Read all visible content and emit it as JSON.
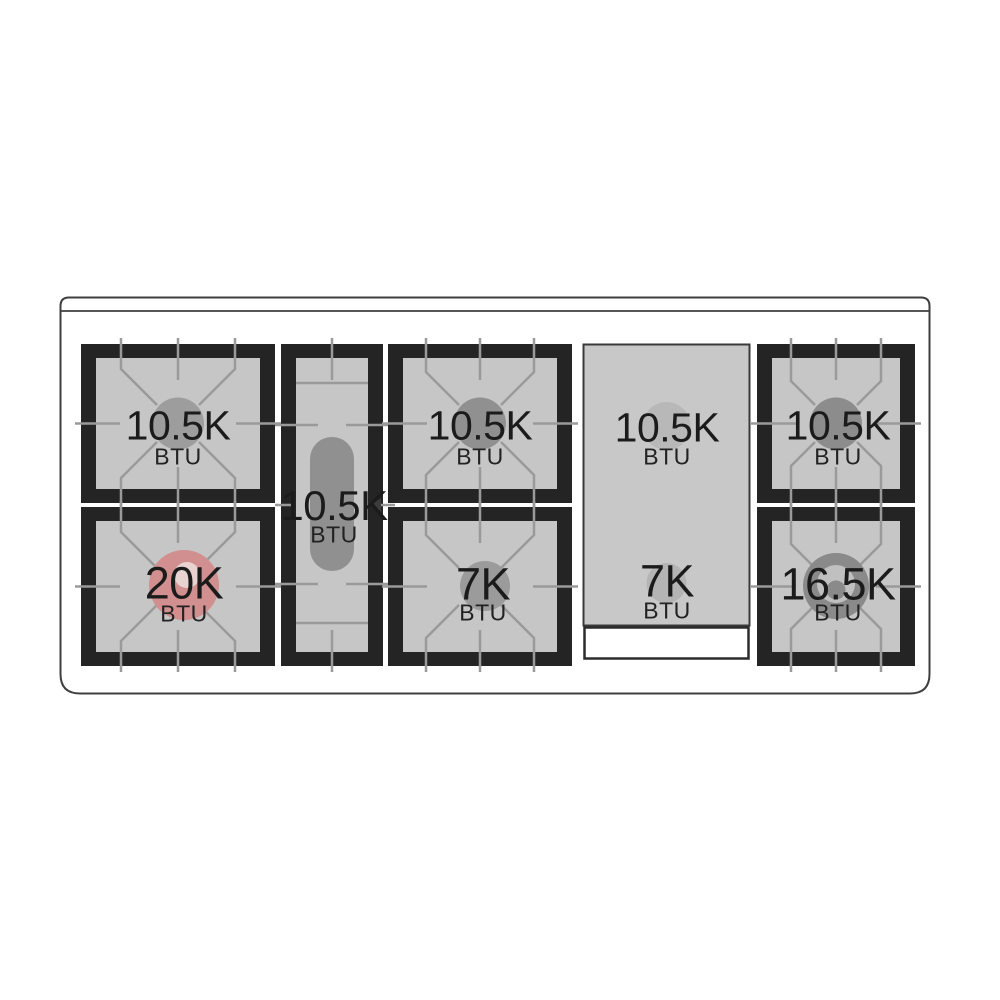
{
  "cooktop": {
    "burners": [
      {
        "id": "left-rear",
        "value": "10.5K",
        "unit": "BTU"
      },
      {
        "id": "left-front",
        "value": "20K",
        "unit": "BTU"
      },
      {
        "id": "center-oval",
        "value": "10.5K",
        "unit": "BTU"
      },
      {
        "id": "middle-rear",
        "value": "10.5K",
        "unit": "BTU"
      },
      {
        "id": "middle-front",
        "value": "7K",
        "unit": "BTU"
      },
      {
        "id": "griddle-rear",
        "value": "10.5K",
        "unit": "BTU"
      },
      {
        "id": "griddle-front",
        "value": "7K",
        "unit": "BTU"
      },
      {
        "id": "right-rear",
        "value": "10.5K",
        "unit": "BTU"
      },
      {
        "id": "right-front",
        "value": "16.5K",
        "unit": "BTU"
      }
    ],
    "colors": {
      "background": "#ffffff",
      "outline": "#3f3f3f",
      "grate_frame": "#242424",
      "grate_surface": "#c6c6c7",
      "grate_lines": "#9a9a9a",
      "burner_gray": "#909090",
      "burner_highlight_red": "#d18f8f",
      "burner_highlight_inner": "#e8d3d1",
      "dual_ring_light": "#c0c0c0",
      "griddle_surface": "#c8c8c8",
      "griddle_burner": "#b6b6b6",
      "label_text": "#1b1b1b"
    }
  }
}
